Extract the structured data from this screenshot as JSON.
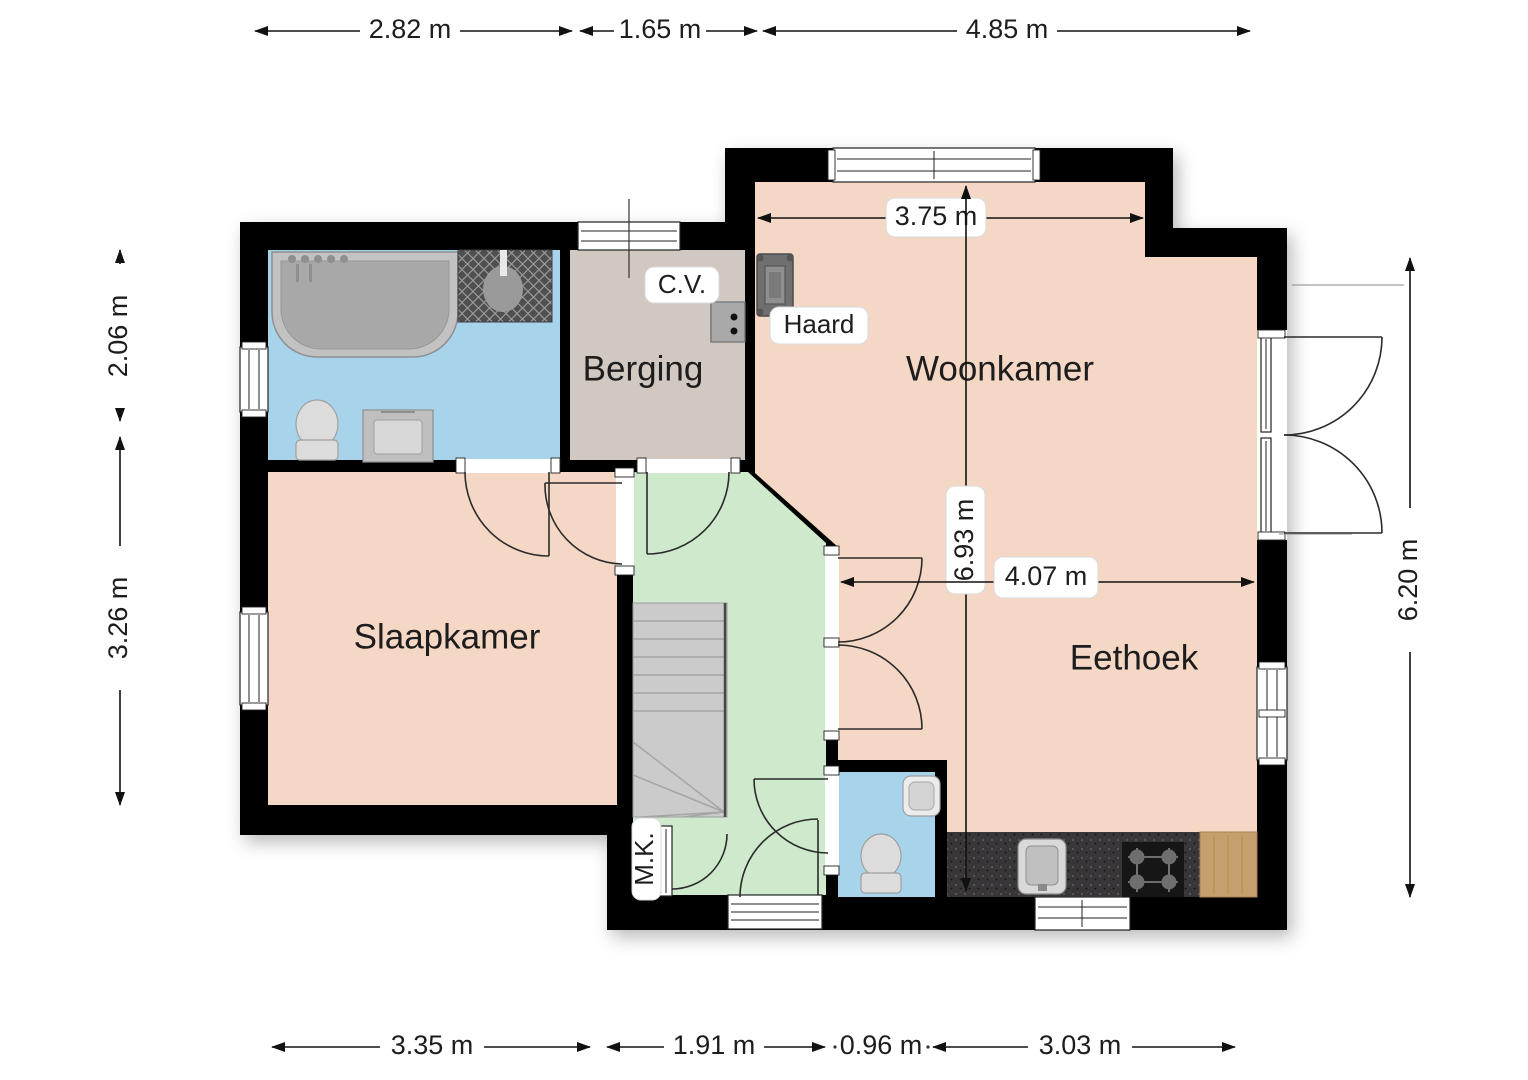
{
  "rooms": [
    {
      "id": "woonkamer",
      "label": "Woonkamer"
    },
    {
      "id": "eethoek",
      "label": "Eethoek"
    },
    {
      "id": "slaapkamer",
      "label": "Slaapkamer"
    },
    {
      "id": "berging",
      "label": "Berging"
    }
  ],
  "annotations": {
    "boiler": "C.V.",
    "fireplace": "Haard",
    "meter_cupboard": "M.K."
  },
  "dimensions": {
    "top": [
      "2.82 m",
      "1.65 m",
      "4.85 m"
    ],
    "bottom": [
      "3.35 m",
      "1.91 m",
      "0.96 m",
      "3.03 m"
    ],
    "left": [
      "2.06 m",
      "3.26 m"
    ],
    "right": [
      "6.20 m"
    ],
    "interior": {
      "woonkamer_width": "3.75 m",
      "house_depth": "6.93 m",
      "eethoek_width": "4.07 m"
    }
  },
  "colors": {
    "wall": "#000000",
    "living_rooms": "#f5d7c6",
    "wet_rooms": "#a7d3eb",
    "hallway": "#cfe9cd",
    "storage": "#d2c8c2",
    "counter": "#39363a",
    "wood": "#c6a06c",
    "stairs": "#cbcbcb",
    "label_bg": "#ffffff",
    "line": "#111111"
  }
}
